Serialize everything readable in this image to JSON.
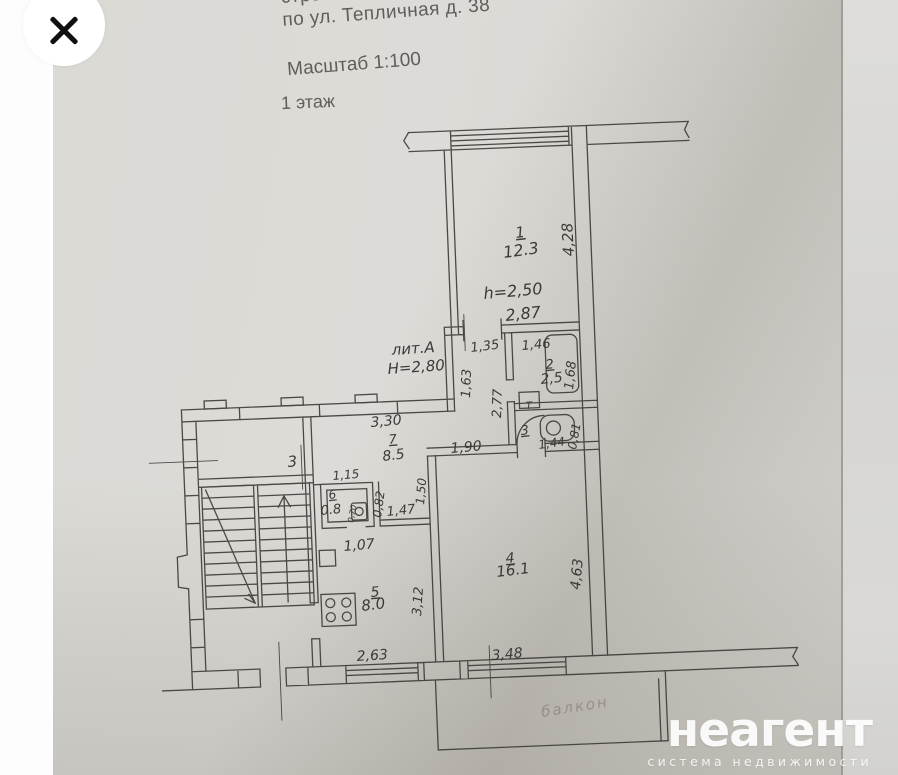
{
  "viewer": {
    "icons": {
      "close": "x-cross"
    }
  },
  "document": {
    "header": {
      "line1": "строения лит.",
      "line2": "по ул. Тепличная д. 38",
      "scale": "Масштаб 1:100",
      "floor": "1 этаж"
    }
  },
  "plan": {
    "litera": "лит.А",
    "height_note": "Н=2,80",
    "rooms": [
      {
        "number": "1",
        "area": "12.3"
      },
      {
        "number": "2",
        "area": "2,5"
      },
      {
        "number": "3",
        "area": ""
      },
      {
        "number": "4",
        "area": "16.1"
      },
      {
        "number": "5",
        "area": "8.0"
      },
      {
        "number": "6",
        "area": "0.8"
      },
      {
        "number": "7",
        "area": "8.5"
      }
    ],
    "labels": [
      {
        "text": "1",
        "x": 516,
        "y": 238,
        "size": 15,
        "rot": -7,
        "u": 1
      },
      {
        "text": "12.3",
        "x": 504,
        "y": 258,
        "size": 16,
        "rot": -8
      },
      {
        "text": "4,28",
        "x": 574,
        "y": 256,
        "size": 15,
        "rot": -93
      },
      {
        "text": "h=2,50",
        "x": 484,
        "y": 299,
        "size": 16,
        "rot": -5
      },
      {
        "text": "2,87",
        "x": 506,
        "y": 321,
        "size": 16,
        "rot": -6
      },
      {
        "text": "лит.А",
        "x": 392,
        "y": 355,
        "size": 15,
        "rot": -4
      },
      {
        "text": "Н=2,80",
        "x": 388,
        "y": 374,
        "size": 15,
        "rot": -4
      },
      {
        "text": "1,35",
        "x": 471,
        "y": 352,
        "size": 13,
        "rot": -7
      },
      {
        "text": "1,46",
        "x": 522,
        "y": 350,
        "size": 13,
        "rot": -5
      },
      {
        "text": "2",
        "x": 546,
        "y": 369,
        "size": 13,
        "rot": -6,
        "u": 1
      },
      {
        "text": "2,5",
        "x": 541,
        "y": 384,
        "size": 14,
        "rot": -6
      },
      {
        "text": "1,68",
        "x": 573,
        "y": 390,
        "size": 13,
        "rot": -84
      },
      {
        "text": "2,77",
        "x": 501,
        "y": 418,
        "size": 13,
        "rot": -88
      },
      {
        "text": "1,63",
        "x": 470,
        "y": 398,
        "size": 13,
        "rot": -88
      },
      {
        "text": "Т",
        "x": 526,
        "y": 409,
        "size": 10,
        "rot": -3
      },
      {
        "text": "3",
        "x": 521,
        "y": 435,
        "size": 13,
        "rot": -6,
        "u": 1
      },
      {
        "text": "1,44",
        "x": 539,
        "y": 449,
        "size": 12,
        "rot": -8
      },
      {
        "text": "0,81",
        "x": 576,
        "y": 450,
        "size": 12,
        "rot": -80
      },
      {
        "text": "3,30",
        "x": 371,
        "y": 427,
        "size": 14,
        "rot": -5
      },
      {
        "text": "7",
        "x": 389,
        "y": 444,
        "size": 13,
        "rot": -5,
        "u": 1
      },
      {
        "text": "8.5",
        "x": 383,
        "y": 461,
        "size": 14,
        "rot": -7
      },
      {
        "text": "1,90",
        "x": 451,
        "y": 453,
        "size": 14,
        "rot": -5
      },
      {
        "text": "3",
        "x": 288,
        "y": 467,
        "size": 15,
        "rot": -5
      },
      {
        "text": "1,15",
        "x": 333,
        "y": 480,
        "size": 12,
        "rot": -5
      },
      {
        "text": "6",
        "x": 329,
        "y": 499,
        "size": 12,
        "rot": -6,
        "u": 1
      },
      {
        "text": "0.8",
        "x": 321,
        "y": 515,
        "size": 13,
        "rot": -6
      },
      {
        "text": "0,70",
        "x": 353,
        "y": 523,
        "size": 8,
        "rot": -78
      },
      {
        "text": "0,82",
        "x": 381,
        "y": 518,
        "size": 12,
        "rot": -82
      },
      {
        "text": "1,47",
        "x": 387,
        "y": 516,
        "size": 13,
        "rot": -6
      },
      {
        "text": "1,50",
        "x": 424,
        "y": 505,
        "size": 12,
        "rot": -85
      },
      {
        "text": "1,07",
        "x": 344,
        "y": 551,
        "size": 14,
        "rot": -5
      },
      {
        "text": "5",
        "x": 371,
        "y": 597,
        "size": 14,
        "rot": -5,
        "u": 1
      },
      {
        "text": "8.0",
        "x": 362,
        "y": 611,
        "size": 15,
        "rot": -7
      },
      {
        "text": "3,12",
        "x": 421,
        "y": 616,
        "size": 13,
        "rot": -86
      },
      {
        "text": "4",
        "x": 506,
        "y": 563,
        "size": 14,
        "rot": -5,
        "u": 1
      },
      {
        "text": "16.1",
        "x": 497,
        "y": 577,
        "size": 15,
        "rot": -7
      },
      {
        "text": "4,63",
        "x": 580,
        "y": 590,
        "size": 14,
        "rot": -85
      },
      {
        "text": "2,63",
        "x": 357,
        "y": 661,
        "size": 14,
        "rot": -4
      },
      {
        "text": "3,48",
        "x": 492,
        "y": 660,
        "size": 14,
        "rot": -5
      },
      {
        "text": "балкон",
        "x": 542,
        "y": 717,
        "size": 15,
        "rot": -9,
        "hand": 1
      }
    ]
  },
  "watermark": {
    "brand": "неагент",
    "tagline": "система недвижимости"
  },
  "colors": {
    "paper": "#d9d7d2",
    "line": "#3e3d3a",
    "ink": "#3b3a38",
    "watermark": "#ffffff"
  }
}
